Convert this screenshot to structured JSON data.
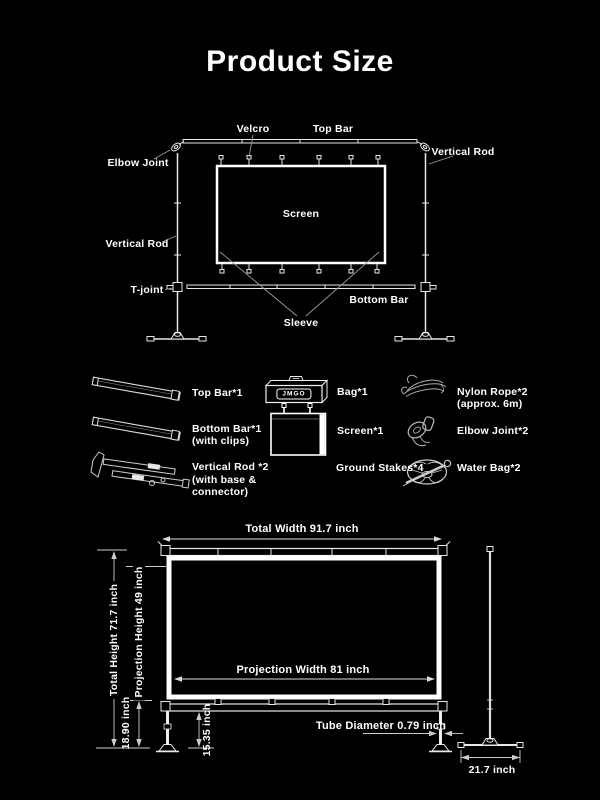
{
  "title": "Product Size",
  "assembly": {
    "velcro": "Velcro",
    "top_bar": "Top Bar",
    "elbow_joint": "Elbow Joint",
    "vertical_rod_right": "Vertical Rod",
    "vertical_rod_left": "Vertical Rod",
    "t_joint": "T-joint",
    "bottom_bar": "Bottom Bar",
    "sleeve": "Sleeve",
    "screen": "Screen"
  },
  "parts": {
    "top_bar": {
      "label": "Top Bar*1"
    },
    "bottom_bar": {
      "label": "Bottom Bar*1",
      "note": "(with clips)"
    },
    "vertical_rod": {
      "label": "Vertical Rod *2",
      "note_line1": "(with base &",
      "note_line2": "connector)"
    },
    "bag": {
      "label": "Bag*1",
      "logo": "JMGO"
    },
    "screen": {
      "label": "Screen*1"
    },
    "ground_stakes": {
      "label": "Ground Stakes*4"
    },
    "nylon_rope": {
      "label": "Nylon Rope*2",
      "note": "(approx. 6m)"
    },
    "elbow_joint": {
      "label": "Elbow Joint*2"
    },
    "water_bag": {
      "label": "Water Bag*2"
    }
  },
  "dimensions": {
    "total_width": "Total Width 91.7 inch",
    "projection_width": "Projection Width 81 inch",
    "total_height": "Total Height 71.7 inch",
    "projection_height": "Projection Height 49 inch",
    "frame_to_ground": "18.90 inch",
    "bar_to_ground": "15.35 inch",
    "tube_diameter": "Tube Diameter 0.79 inch",
    "base_width": "21.7 inch"
  },
  "colors": {
    "background": "#000000",
    "text": "#ffffff",
    "line": "#f0f0f0",
    "leader": "#999999"
  }
}
